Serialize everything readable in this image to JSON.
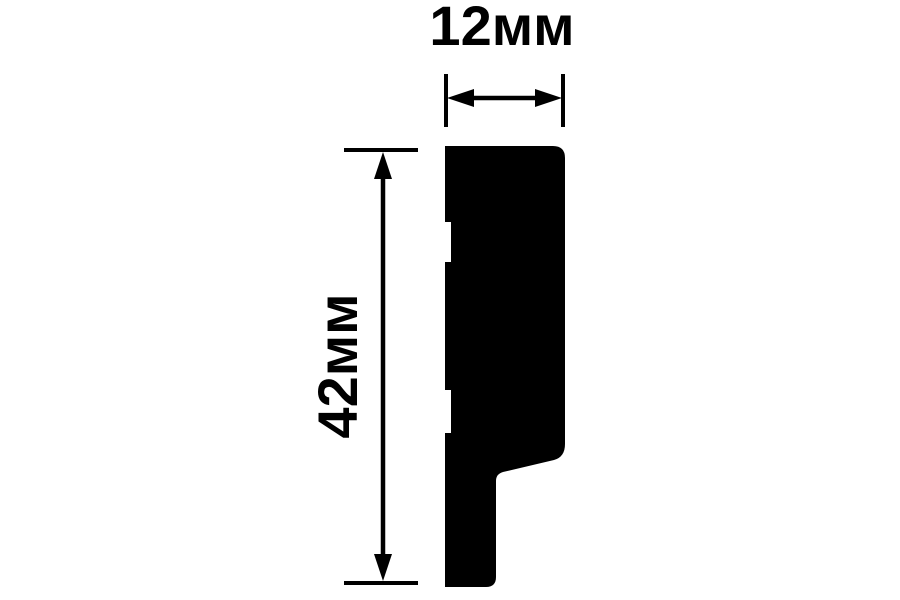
{
  "drawing": {
    "type": "profile-cross-section-dimension-drawing",
    "width_label": "12мм",
    "height_label": "42мм",
    "width_value_mm": 12,
    "height_value_mm": 42,
    "ink_color": "#000000",
    "background_color": "#ffffff",
    "profile_path": "M445 146 H553 Q565 146 565 158 V444 Q565 457 554 460 L503 472 Q496 474 496 481 V577 Q496 587 486 587 H445 V433 H451 V390 H445 V262 H451 V222 H445 Z"
  }
}
